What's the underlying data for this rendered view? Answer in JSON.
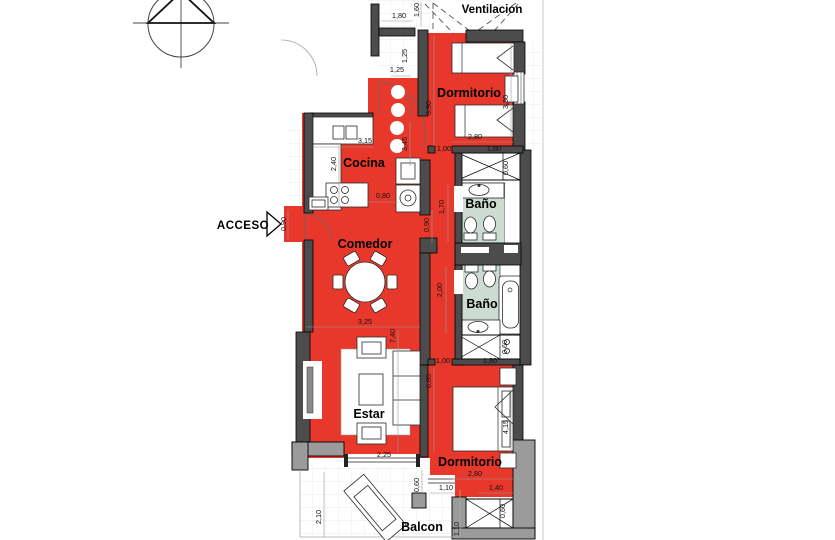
{
  "plan": {
    "rooms": {
      "ventilacion": "Ventilacion",
      "dormitorio_top": "Dormitorio",
      "cocina": "Cocina",
      "comedor": "Comedor",
      "bano_top": "Baño",
      "bano_bottom": "Baño",
      "estar": "Estar",
      "dormitorio_bottom": "Dormitorio",
      "balcon": "Balcon"
    },
    "entry_label": "ACCESO",
    "dims": [
      "1,80",
      "1,60",
      "1,25",
      "1,25",
      "3,15",
      "2,40",
      "0,80",
      "3,45",
      "0,90",
      "0,90",
      "3,90",
      "3,30",
      "2,80",
      "1,00",
      "1,80",
      "0,60",
      "1,70",
      "2,00",
      "0,60",
      "1,00",
      "1,80",
      "3,25",
      "7,40",
      "6,85",
      "4,15",
      "2,80",
      "1,10",
      "1,40",
      "2,25",
      "0,60",
      "2,10",
      "0,60",
      "1,10"
    ],
    "colors": {
      "room_fill": "#e8382b",
      "wall_dark": "#4c4c4c",
      "wall_light": "#9b9b9b",
      "bath_floor": "#ccdcd3"
    },
    "icons": {
      "compass": "north-compass",
      "entry_arrow": "entry-direction-arrow"
    }
  }
}
